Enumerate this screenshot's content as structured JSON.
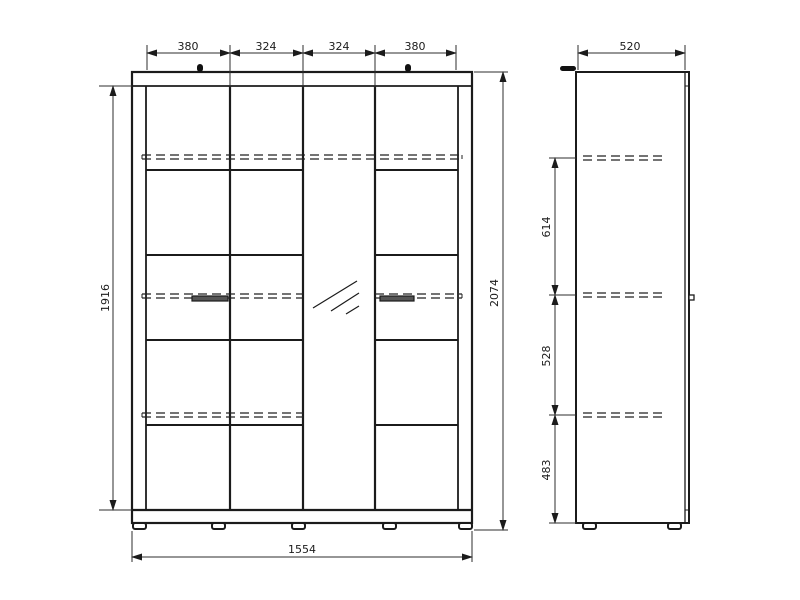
{
  "drawing": {
    "description": "wardrobe-technical-drawing",
    "front_view": {
      "top_dims": [
        "380",
        "324",
        "324",
        "380"
      ],
      "carcass_height": "1916",
      "total_height": "2074",
      "total_width": "1554"
    },
    "side_view": {
      "depth": "520",
      "shelf_spacings": [
        "614",
        "528",
        "483"
      ]
    },
    "colors": {
      "line": "#1b1b1b",
      "dim_line": "#2e2e2e",
      "background": "#ffffff"
    }
  }
}
